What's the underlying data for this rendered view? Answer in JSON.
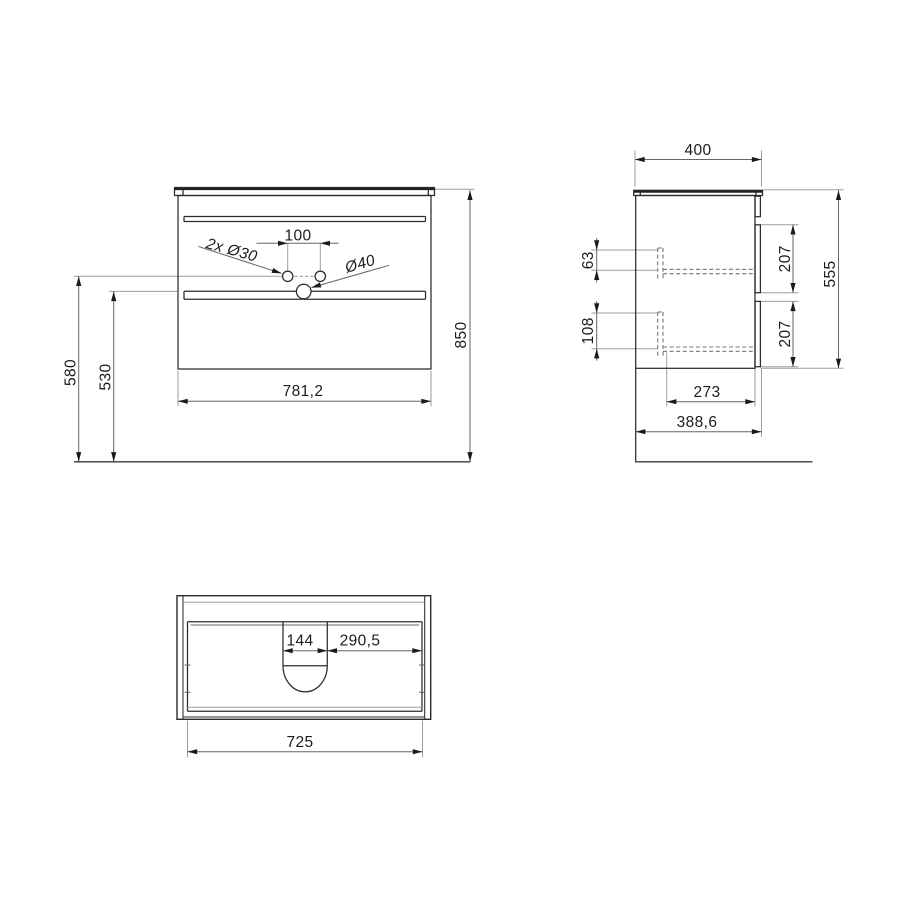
{
  "drawing": {
    "type": "technical-drawing",
    "subject": "wall-hung vanity cabinet with two drawers, basin top and siphon cutout",
    "background_color": "#ffffff",
    "line_color": "#2b2b2b",
    "dimension_line_color": "#666666",
    "extension_line_color": "#9e9e9e",
    "text_color": "#1c1c1c"
  },
  "views": {
    "front": {
      "label": "front-view",
      "dims": {
        "hole_spacing": "100",
        "faucet_holes": "2x Ø30",
        "drain_hole": "Ø40",
        "width": "781,2",
        "height_holes": "580",
        "height_mid": "530",
        "height_total": "850"
      }
    },
    "side": {
      "label": "side-view",
      "dims": {
        "depth_top": "400",
        "inner_top": "63",
        "inner_bottom": "108",
        "drawer_front_upper": "207",
        "drawer_front_lower": "207",
        "height": "555",
        "drawer_depth": "273",
        "depth_total": "388,6"
      }
    },
    "top": {
      "label": "top-view",
      "dims": {
        "cutout_width": "144",
        "cutout_to_side": "290,5",
        "inner_width": "725"
      }
    }
  }
}
